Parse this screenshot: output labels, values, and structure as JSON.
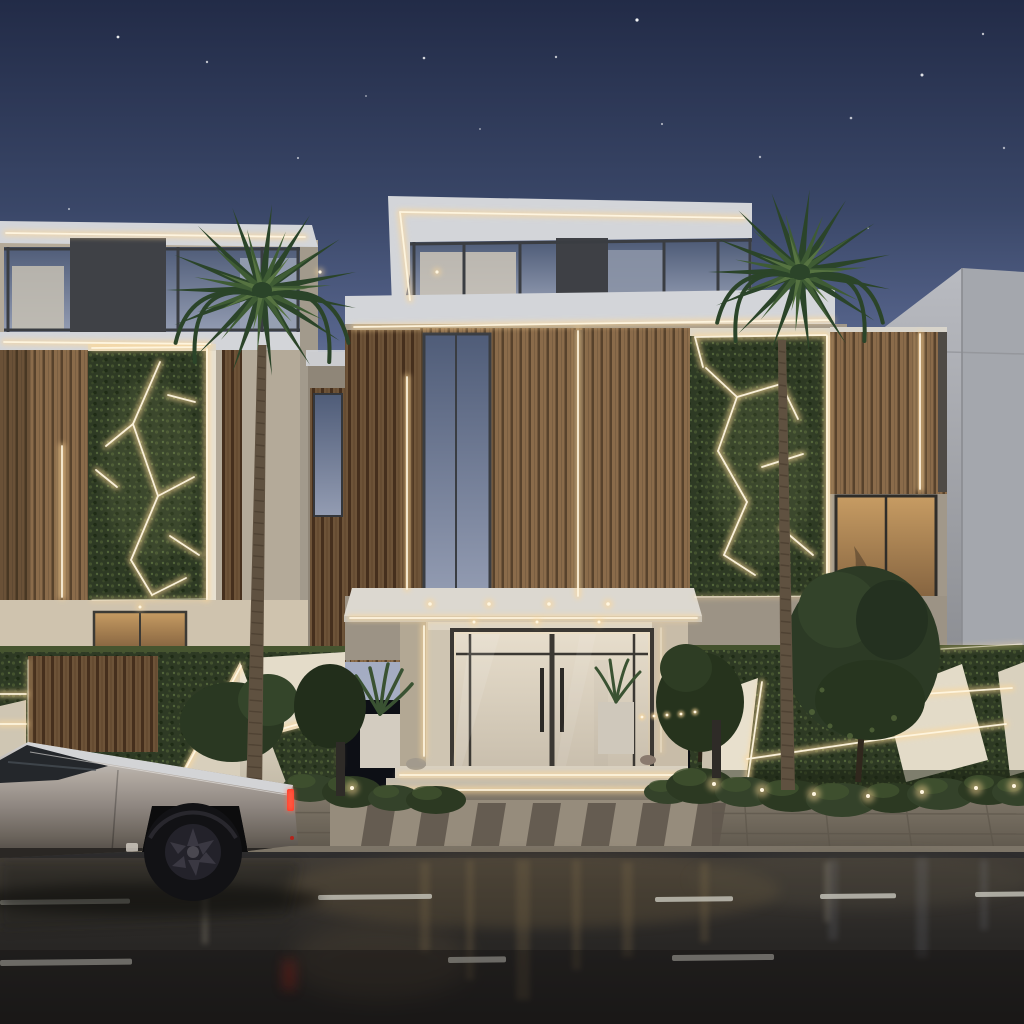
{
  "meta": {
    "title": "Photorealistic dusk rendering of a modern luxury villa facade with LED strip lighting, vertical gardens, two palm trees and a silver Cybertruck parked on a wet street",
    "type": "architectural render",
    "time_of_day": "dusk"
  },
  "palette": {
    "sky_top": "#222b47",
    "sky_mid": "#4d5a82",
    "sky_horizon": "#9aa3bb",
    "fascia": "#d3d5d9",
    "fascia_lit": "#efe9da",
    "beige": "#b4aa99",
    "beige_dark": "#a1988a",
    "beige_lit": "#cfc3ae",
    "wood_base": "#8a6b4a",
    "wood_gap": "#57422c",
    "wood_dark_base": "#6d5338",
    "wood_dark_gap": "#452f1d",
    "glass_frame": "#3a3d42",
    "hedge_base": "#2e3a24",
    "white_panel_lit": "#e9e1cf",
    "white_panel_shade": "#b7ae9c",
    "led_core": "#fff6e0",
    "led_glow": "#ffd998",
    "road_top": "#36332f",
    "road_bottom": "#201f1e",
    "lane_mark": "#c9c7bd",
    "sidewalk": "#776f62",
    "apron": "#968c7c",
    "truck_top": "#d3d4d6",
    "truck_mid": "#a39a91",
    "truck_low": "#756c63",
    "truck_trim": "#2a2724",
    "taillight": "#ff3020",
    "palm_dark": "#2b4429",
    "palm_mid": "#3f5c34",
    "palm_light": "#567341",
    "trunk": "#5f5140",
    "trunk_ring": "#42372a"
  },
  "scene": {
    "sky": {
      "stars": [
        [
          118,
          37,
          1.4,
          0.9
        ],
        [
          207,
          62,
          1.2,
          0.7
        ],
        [
          298,
          158,
          1.1,
          0.6
        ],
        [
          424,
          58,
          1.3,
          0.8
        ],
        [
          556,
          57,
          1.2,
          0.7
        ],
        [
          637,
          20,
          1.6,
          0.95
        ],
        [
          662,
          124,
          1.1,
          0.6
        ],
        [
          760,
          157,
          1.2,
          0.6
        ],
        [
          851,
          118,
          1.3,
          0.7
        ],
        [
          922,
          75,
          1.5,
          0.85
        ],
        [
          983,
          34,
          1.2,
          0.7
        ],
        [
          1004,
          148,
          1.2,
          0.6
        ],
        [
          69,
          209,
          1.1,
          0.55
        ],
        [
          480,
          129,
          1.0,
          0.5
        ],
        [
          868,
          228,
          1.1,
          0.5
        ],
        [
          366,
          96,
          1.0,
          0.5
        ]
      ]
    },
    "palms": [
      {
        "cx": 262,
        "cy": 290,
        "r": 96,
        "trunk": {
          "x_top": 262,
          "y_top": 345,
          "x_bottom": 254,
          "y_bottom": 800,
          "w_top": 9,
          "w_bottom": 16
        }
      },
      {
        "cx": 800,
        "cy": 272,
        "r": 92,
        "trunk": {
          "x_top": 782,
          "y_top": 340,
          "x_bottom": 788,
          "y_bottom": 790,
          "w_top": 8,
          "w_bottom": 14
        }
      }
    ],
    "bushes": [
      [
        310,
        788,
        28,
        14
      ],
      [
        352,
        792,
        30,
        16
      ],
      [
        394,
        798,
        26,
        13
      ],
      [
        436,
        800,
        30,
        14
      ],
      [
        668,
        792,
        24,
        12
      ],
      [
        700,
        786,
        34,
        18
      ],
      [
        745,
        792,
        30,
        15
      ],
      [
        792,
        796,
        34,
        16
      ],
      [
        842,
        800,
        36,
        17
      ],
      [
        893,
        798,
        32,
        15
      ],
      [
        941,
        794,
        34,
        16
      ],
      [
        988,
        790,
        30,
        15
      ],
      [
        1018,
        792,
        26,
        14
      ]
    ],
    "ground_lights": [
      [
        352,
        788
      ],
      [
        714,
        784
      ],
      [
        762,
        790
      ],
      [
        814,
        794
      ],
      [
        868,
        796
      ],
      [
        922,
        792
      ],
      [
        976,
        788
      ],
      [
        1014,
        786
      ]
    ],
    "led_glints": [
      [
        642,
        717
      ],
      [
        654,
        716
      ],
      [
        667,
        715
      ],
      [
        681,
        714
      ],
      [
        695,
        712
      ]
    ],
    "lane_dashes": [
      [
        0,
        900,
        130,
        5
      ],
      [
        318,
        895,
        114,
        5
      ],
      [
        655,
        897,
        78,
        5
      ],
      [
        820,
        894,
        76,
        5
      ],
      [
        975,
        892,
        50,
        5
      ],
      [
        0,
        960,
        132,
        6
      ],
      [
        448,
        957,
        58,
        6
      ],
      [
        672,
        955,
        102,
        6
      ]
    ],
    "crosswalk": {
      "x_start": 368,
      "step": 55,
      "count": 7,
      "stripe_w": 28,
      "y_top": 803,
      "y_bottom": 846
    },
    "buildings": {
      "left": "Two-storey white volume, upper glass band with dark mullions, wood slat panels, vertical-garden wall framed by an LED-lit white border with angular LED light lines",
      "center": "Main villa with stepped white fascias outlined in warm LED strips, wood slat cladding, tall glazing, vertical LED grooves and a second vertical-garden LED wall",
      "right": "Wood slat box with vertical LED strip beside a plain white concrete block with diagonal roofline"
    },
    "entrance": "Recessed porch with white canopy, warm downlights, steel-framed double glass doors with long vertical handles, flanking planters and LED-underlit stone steps",
    "walls": "Low boundary walls covered in hedge greenery with white faceted concrete insets edged by warm LED strips; wood slat gate on the left",
    "vehicle": {
      "type": "Tesla Cybertruck",
      "color": "silver",
      "state": "parked, red taillight lit",
      "position": "left foreground on wet road"
    },
    "road": {
      "surface": "wet asphalt with warm light reflections",
      "markings": "white dashed lane lines",
      "crosswalk": "striped pedestrian crossing at entrance"
    }
  }
}
